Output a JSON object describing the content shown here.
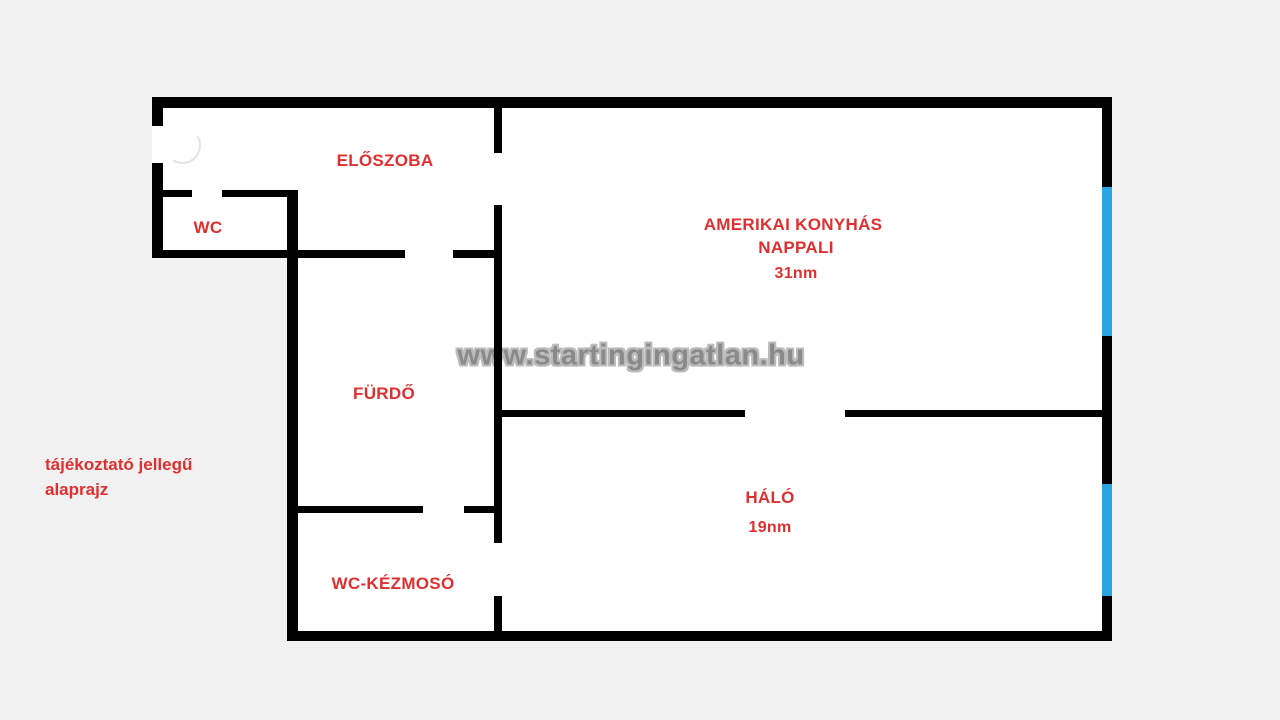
{
  "caption": {
    "line1": "tájékoztató jellegű",
    "line2": "alaprajz"
  },
  "watermark": {
    "text": "www.startingingatlan.hu"
  },
  "rooms": {
    "eloszoba": {
      "name": "ELŐSZOBA"
    },
    "wc": {
      "name": "WC"
    },
    "nappali": {
      "name_line1": "AMERIKAI KONYHÁS",
      "name_line2": "NAPPALI",
      "area": "31nm"
    },
    "furdo": {
      "name": "FÜRDŐ"
    },
    "halo": {
      "name": "HÁLÓ",
      "area": "19nm"
    },
    "wc_kezmoso": {
      "name": "WC-KÉZMOSÓ"
    }
  },
  "colors": {
    "background": "#f1f1f2",
    "floor": "#ffffff",
    "wall": "#000000",
    "window": "#29a4e0",
    "label": "#e12f2f",
    "watermark_fill": "#8a8a8a",
    "watermark_outline": "#bcbcbc"
  }
}
